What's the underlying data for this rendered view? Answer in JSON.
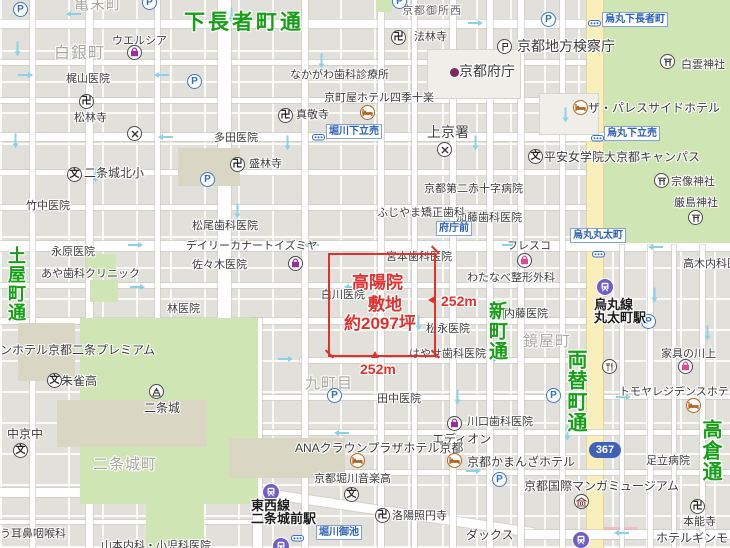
{
  "annotation": {
    "title_line1": "高陽院",
    "title_line2": "敷地",
    "area": "約2097坪",
    "dim_right": "252m",
    "dim_bottom": "252m",
    "color": "#e0312d"
  },
  "route_badge": {
    "text": "367"
  },
  "road_labels": [
    {
      "text": "下長者町通",
      "x": 184,
      "y": 6,
      "vertical": false,
      "size": 21
    },
    {
      "text": "土屋町通",
      "x": 3,
      "y": 246,
      "vertical": true,
      "size": 18
    },
    {
      "text": "新町通",
      "x": 483,
      "y": 301,
      "vertical": true,
      "size": 19
    },
    {
      "text": "両替町通",
      "x": 561,
      "y": 349,
      "vertical": true,
      "size": 20
    },
    {
      "text": "高倉通",
      "x": 696,
      "y": 419,
      "vertical": true,
      "size": 20
    }
  ],
  "town_labels": [
    {
      "text": "白銀町",
      "x": 54,
      "y": 39,
      "size": 16
    },
    {
      "text": "亀末町",
      "x": 74,
      "y": -7,
      "size": 15
    },
    {
      "text": "京都御所西",
      "x": 402,
      "y": 2,
      "size": 11,
      "dark": true
    },
    {
      "text": "九町目",
      "x": 305,
      "y": 372,
      "size": 15
    },
    {
      "text": "鏡屋町",
      "x": 523,
      "y": 330,
      "size": 15
    },
    {
      "text": "二条城町",
      "x": 93,
      "y": 453,
      "size": 15
    }
  ],
  "poi_labels": [
    {
      "text": "ウエルシア",
      "x": 112,
      "y": 35
    },
    {
      "text": "梶山医院",
      "x": 66,
      "y": 73
    },
    {
      "text": "松林寺",
      "x": 74,
      "y": 112
    },
    {
      "text": "真敬寺",
      "x": 296,
      "y": 109
    },
    {
      "text": "法林寺",
      "x": 414,
      "y": 31
    },
    {
      "text": "なかがわ歯科診療所",
      "x": 290,
      "y": 69
    },
    {
      "text": "京町屋ホテル四季十楽",
      "x": 324,
      "y": 92
    },
    {
      "text": "多田医院",
      "x": 214,
      "y": 132
    },
    {
      "text": "盛林寺",
      "x": 249,
      "y": 158
    },
    {
      "text": "二条城北小",
      "x": 84,
      "y": 167,
      "size": 12
    },
    {
      "text": "竹中医院",
      "x": 26,
      "y": 200
    },
    {
      "text": "松尾歯科医院",
      "x": 192,
      "y": 220
    },
    {
      "text": "デイリーカナートイズミヤ",
      "x": 186,
      "y": 240
    },
    {
      "text": "永原医院",
      "x": 51,
      "y": 246
    },
    {
      "text": "佐々木医院",
      "x": 192,
      "y": 259
    },
    {
      "text": "あや歯科クリニック",
      "x": 41,
      "y": 268
    },
    {
      "text": "林医院",
      "x": 167,
      "y": 303
    },
    {
      "text": "白川医院",
      "x": 321,
      "y": 289
    },
    {
      "text": "宮本歯科医院",
      "x": 386,
      "y": 251
    },
    {
      "text": "わたなべ整形外科",
      "x": 467,
      "y": 272
    },
    {
      "text": "松永医院",
      "x": 426,
      "y": 323
    },
    {
      "text": "はやせ歯科医院",
      "x": 409,
      "y": 348
    },
    {
      "text": "内藤医院",
      "x": 504,
      "y": 308
    },
    {
      "text": "フレスコ",
      "x": 507,
      "y": 240
    },
    {
      "text": "ふじやま矯正歯科",
      "x": 377,
      "y": 207
    },
    {
      "text": "加藤歯科医院",
      "x": 456,
      "y": 212
    },
    {
      "text": "京都第二赤十字病院",
      "x": 424,
      "y": 183
    },
    {
      "text": "平安女学院大京都キャンパス",
      "x": 544,
      "y": 151,
      "size": 12
    },
    {
      "text": "宗像神社",
      "x": 671,
      "y": 176
    },
    {
      "text": "厳島神社",
      "x": 674,
      "y": 197
    },
    {
      "text": "白雲神社",
      "x": 681,
      "y": 59
    },
    {
      "text": "ザ・パレスサイドホテル",
      "x": 588,
      "y": 102,
      "size": 12
    },
    {
      "text": "京都地方検察庁",
      "x": 517,
      "y": 39,
      "size": 14
    },
    {
      "text": "京都府庁",
      "x": 459,
      "y": 64,
      "size": 14
    },
    {
      "text": "上京署",
      "x": 427,
      "y": 125,
      "size": 14
    },
    {
      "text": "高木内科医院",
      "x": 683,
      "y": 258
    },
    {
      "text": "家具の川上",
      "x": 661,
      "y": 348
    },
    {
      "text": "田中医院",
      "x": 377,
      "y": 393
    },
    {
      "text": "ANAクラウンプラザホテル京都",
      "x": 295,
      "y": 442,
      "size": 12
    },
    {
      "text": "京都堀川音楽高",
      "x": 314,
      "y": 473
    },
    {
      "text": "洛陽照円寺",
      "x": 392,
      "y": 510
    },
    {
      "text": "エディオン",
      "x": 432,
      "y": 433,
      "size": 12
    },
    {
      "text": "川口歯科医院",
      "x": 467,
      "y": 416
    },
    {
      "text": "京都かまんざホテル",
      "x": 467,
      "y": 456,
      "size": 12
    },
    {
      "text": "京都国際マンガミュージアム",
      "x": 524,
      "y": 480,
      "size": 12
    },
    {
      "text": "足立病院",
      "x": 646,
      "y": 455
    },
    {
      "text": "本能寺",
      "x": 683,
      "y": 516
    },
    {
      "text": "ホテルギンモンド",
      "x": 656,
      "y": 532,
      "size": 12
    },
    {
      "text": "ダックス",
      "x": 466,
      "y": 529,
      "size": 12
    },
    {
      "text": "トモヤレジデンスホテル京都",
      "x": 619,
      "y": 386
    },
    {
      "text": "う耳鼻咽喉科",
      "x": 0,
      "y": 528
    },
    {
      "text": "山本内科・小児科医院",
      "x": 101,
      "y": 540
    },
    {
      "text": "中京中",
      "x": 7,
      "y": 428,
      "size": 12
    },
    {
      "text": "朱雀高",
      "x": 61,
      "y": 375,
      "size": 12
    },
    {
      "text": "二条城",
      "x": 144,
      "y": 402,
      "size": 12
    },
    {
      "text": "ンホテル京都二条プレミアム",
      "x": 0,
      "y": 344,
      "size": 12
    }
  ],
  "stations": [
    {
      "lines": [
        "東西線",
        "二条城前駅"
      ],
      "x": 251,
      "y": 499
    },
    {
      "lines": [
        "烏丸線",
        "丸太町駅"
      ],
      "x": 594,
      "y": 298
    }
  ],
  "bus_stops": [
    {
      "text": "烏丸下長者町",
      "x": 602,
      "y": 12
    },
    {
      "text": "堀川下立売",
      "x": 326,
      "y": 124
    },
    {
      "text": "烏丸下立売",
      "x": 604,
      "y": 126
    },
    {
      "text": "府庁前",
      "x": 436,
      "y": 221
    },
    {
      "text": "烏丸丸太町",
      "x": 570,
      "y": 228
    },
    {
      "text": "堀川御池",
      "x": 316,
      "y": 525
    }
  ],
  "icons": [
    {
      "t": "parking",
      "x": 21,
      "y": 10
    },
    {
      "t": "parking",
      "x": 150,
      "y": 3
    },
    {
      "t": "parking",
      "x": 400,
      "y": 2
    },
    {
      "t": "parking",
      "x": 549,
      "y": 20
    },
    {
      "t": "parking",
      "x": 195,
      "y": 82
    },
    {
      "t": "parking",
      "x": 208,
      "y": 180
    },
    {
      "t": "parking",
      "x": 649,
      "y": 322
    },
    {
      "t": "parking",
      "x": 335,
      "y": 396
    },
    {
      "t": "parking",
      "x": 554,
      "y": 396
    },
    {
      "t": "parking",
      "x": 500,
      "y": 480
    },
    {
      "t": "temple",
      "x": 87,
      "y": 102
    },
    {
      "t": "temple",
      "x": 286,
      "y": 116
    },
    {
      "t": "temple",
      "x": 399,
      "y": 38
    },
    {
      "t": "temple",
      "x": 238,
      "y": 165
    },
    {
      "t": "temple",
      "x": 383,
      "y": 516
    },
    {
      "t": "temple",
      "x": 698,
      "y": 507
    },
    {
      "t": "shrine",
      "x": 668,
      "y": 62
    },
    {
      "t": "shrine",
      "x": 662,
      "y": 181
    },
    {
      "t": "shrine",
      "x": 696,
      "y": 218
    },
    {
      "t": "school",
      "x": 75,
      "y": 175
    },
    {
      "t": "school",
      "x": 536,
      "y": 157
    },
    {
      "t": "school",
      "x": 21,
      "y": 451
    },
    {
      "t": "school",
      "x": 55,
      "y": 381
    },
    {
      "t": "school",
      "x": 352,
      "y": 495
    },
    {
      "t": "police",
      "x": 135,
      "y": 134
    },
    {
      "t": "police",
      "x": 445,
      "y": 150
    },
    {
      "t": "hotel",
      "x": 368,
      "y": 113
    },
    {
      "t": "hotel",
      "x": 581,
      "y": 108
    },
    {
      "t": "hotel",
      "x": 358,
      "y": 461
    },
    {
      "t": "hotel",
      "x": 455,
      "y": 461
    },
    {
      "t": "hotel",
      "x": 694,
      "y": 406
    },
    {
      "t": "shop",
      "x": 135,
      "y": 53
    },
    {
      "t": "shop",
      "x": 296,
      "y": 264
    },
    {
      "t": "shop",
      "x": 455,
      "y": 424
    },
    {
      "t": "shop-pink",
      "x": 525,
      "y": 261
    },
    {
      "t": "shop-pink",
      "x": 686,
      "y": 367
    },
    {
      "t": "restaurant",
      "x": 610,
      "y": 367
    },
    {
      "t": "museum",
      "x": 582,
      "y": 502
    },
    {
      "t": "castle",
      "x": 157,
      "y": 392
    },
    {
      "t": "gov",
      "x": 451,
      "y": 72
    },
    {
      "t": "court",
      "x": 505,
      "y": 47
    },
    {
      "t": "subway",
      "x": 271,
      "y": 492
    },
    {
      "t": "subway",
      "x": 605,
      "y": 287
    },
    {
      "t": "subway",
      "x": 581,
      "y": 540
    },
    {
      "t": "subway",
      "x": 281,
      "y": 546
    },
    {
      "t": "bus",
      "x": 594,
      "y": 19
    },
    {
      "t": "bus",
      "x": 318,
      "y": 133
    },
    {
      "t": "bus",
      "x": 597,
      "y": 134
    },
    {
      "t": "bus",
      "x": 598,
      "y": 250
    },
    {
      "t": "bus",
      "x": 297,
      "y": 534
    }
  ]
}
